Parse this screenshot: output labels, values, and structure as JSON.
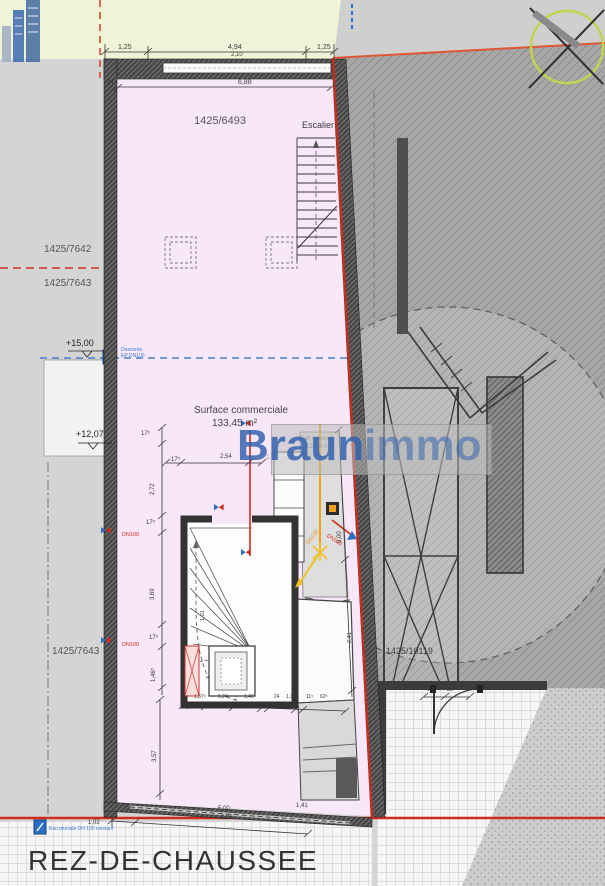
{
  "header": {
    "plan_title": "REZ-DE-CHAUSSEE"
  },
  "watermark": {
    "part1": "Braun",
    "part2": "immo"
  },
  "parcels": {
    "main": "1425/6493",
    "left_upper": "1425/7642",
    "left_mid": "1425/7643",
    "left_lower": "1425/7643",
    "right": "1425/10119"
  },
  "rooms": {
    "stair": "Escalier",
    "surface_label": "Surface commerciale",
    "surface_area": "133,45 m²",
    "hall_label": "Hall couvert",
    "hall_area": "12,06 m²"
  },
  "levels": {
    "upper": "+15,00",
    "lower": "+12,07"
  },
  "annotations": {
    "descente_line1": "Descente",
    "descente_line2": "EP DN100",
    "dn100": "DN100",
    "eau_pluviale": "Eau pluviale DN 100 existant"
  },
  "dimensions": {
    "top": [
      "1,25",
      "4,94",
      "2,10",
      "1,25"
    ],
    "wall_thickness": "34",
    "inner_width": "6,88",
    "tick_175": "17⁵",
    "left_chain": [
      "2,72",
      "3,69",
      "1,46⁵",
      "3,57"
    ],
    "mid": "2,54",
    "stair_chain": [
      "11⁵",
      "1,37⁵",
      "1,24",
      "1,40",
      "24",
      "1,37⁵",
      "11⁵",
      "62⁵"
    ],
    "right_chain": [
      "5,00",
      "2,41",
      "1,01"
    ],
    "bottom": [
      "1,02",
      "5,00",
      "2,20",
      "1,41"
    ],
    "door": [
      "1,6",
      "25⁵"
    ]
  },
  "colors": {
    "boundary_red": "#cf2a1a",
    "utility_blue": "#3f7ed0",
    "utility_orange": "#f0a01e",
    "surface_pink": "#f8e7f9",
    "parcel_yellow": "#eff3d8",
    "watermark_blue": "#2e5fae"
  }
}
